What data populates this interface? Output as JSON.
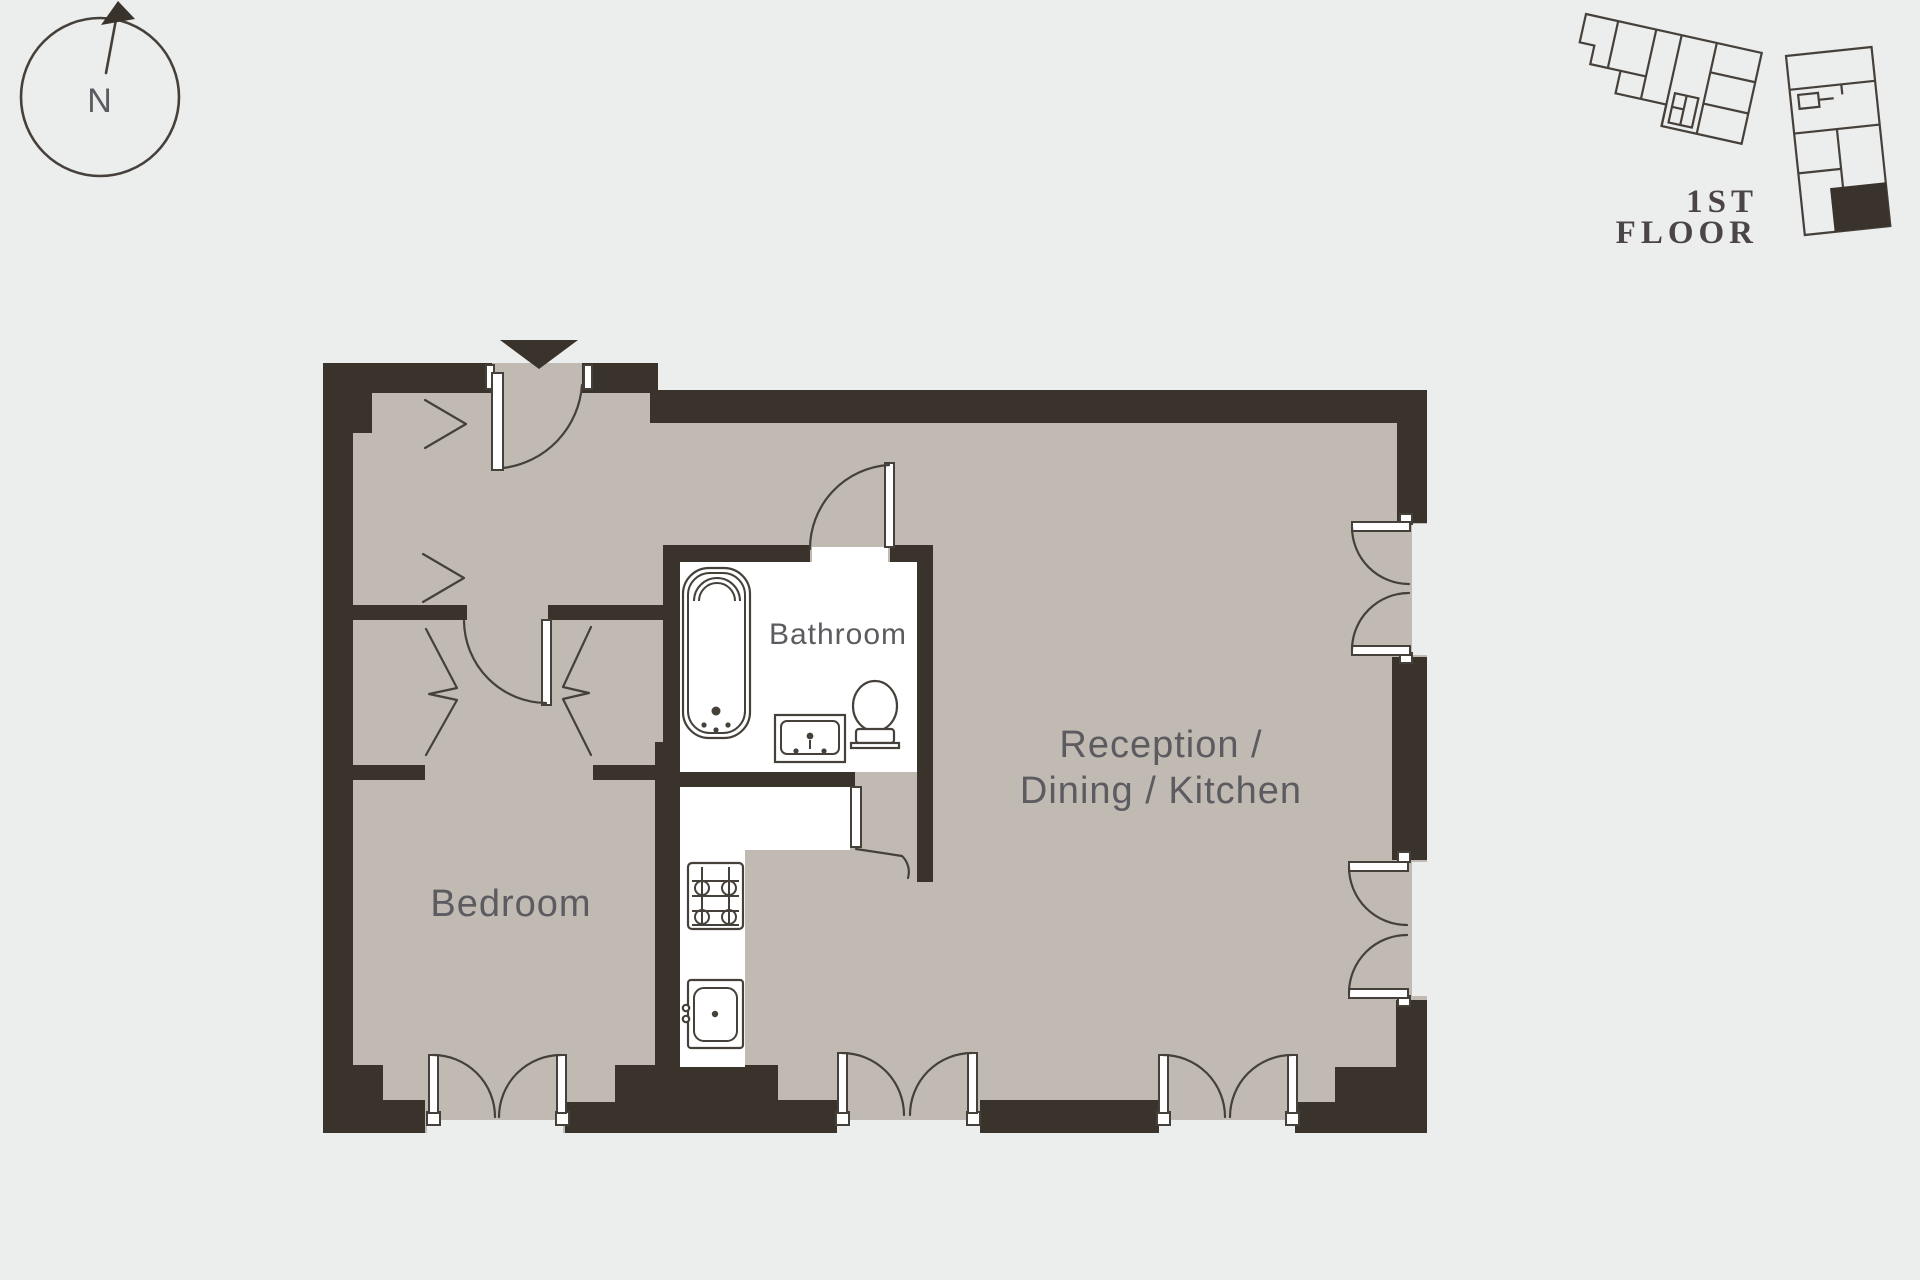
{
  "palette": {
    "background": "#eceded",
    "wall": "#3a332c",
    "floor": "#c0bab3",
    "line": "#46403a",
    "room_label": "#5c5b60",
    "serif_label": "#4c4547",
    "fixture_fill": "#ffffff"
  },
  "compass": {
    "label": "N"
  },
  "site_plan": {
    "floor_line1": "1ST",
    "floor_line2": "FLOOR"
  },
  "floorplan": {
    "labels": {
      "bathroom": "Bathroom",
      "bedroom": "Bedroom",
      "reception_line1": "Reception /",
      "reception_line2": "Dining / Kitchen"
    }
  },
  "icons": {
    "north_arrow_icon": "triangle-up-arrow",
    "entrance_marker_icon": "triangle-down"
  }
}
